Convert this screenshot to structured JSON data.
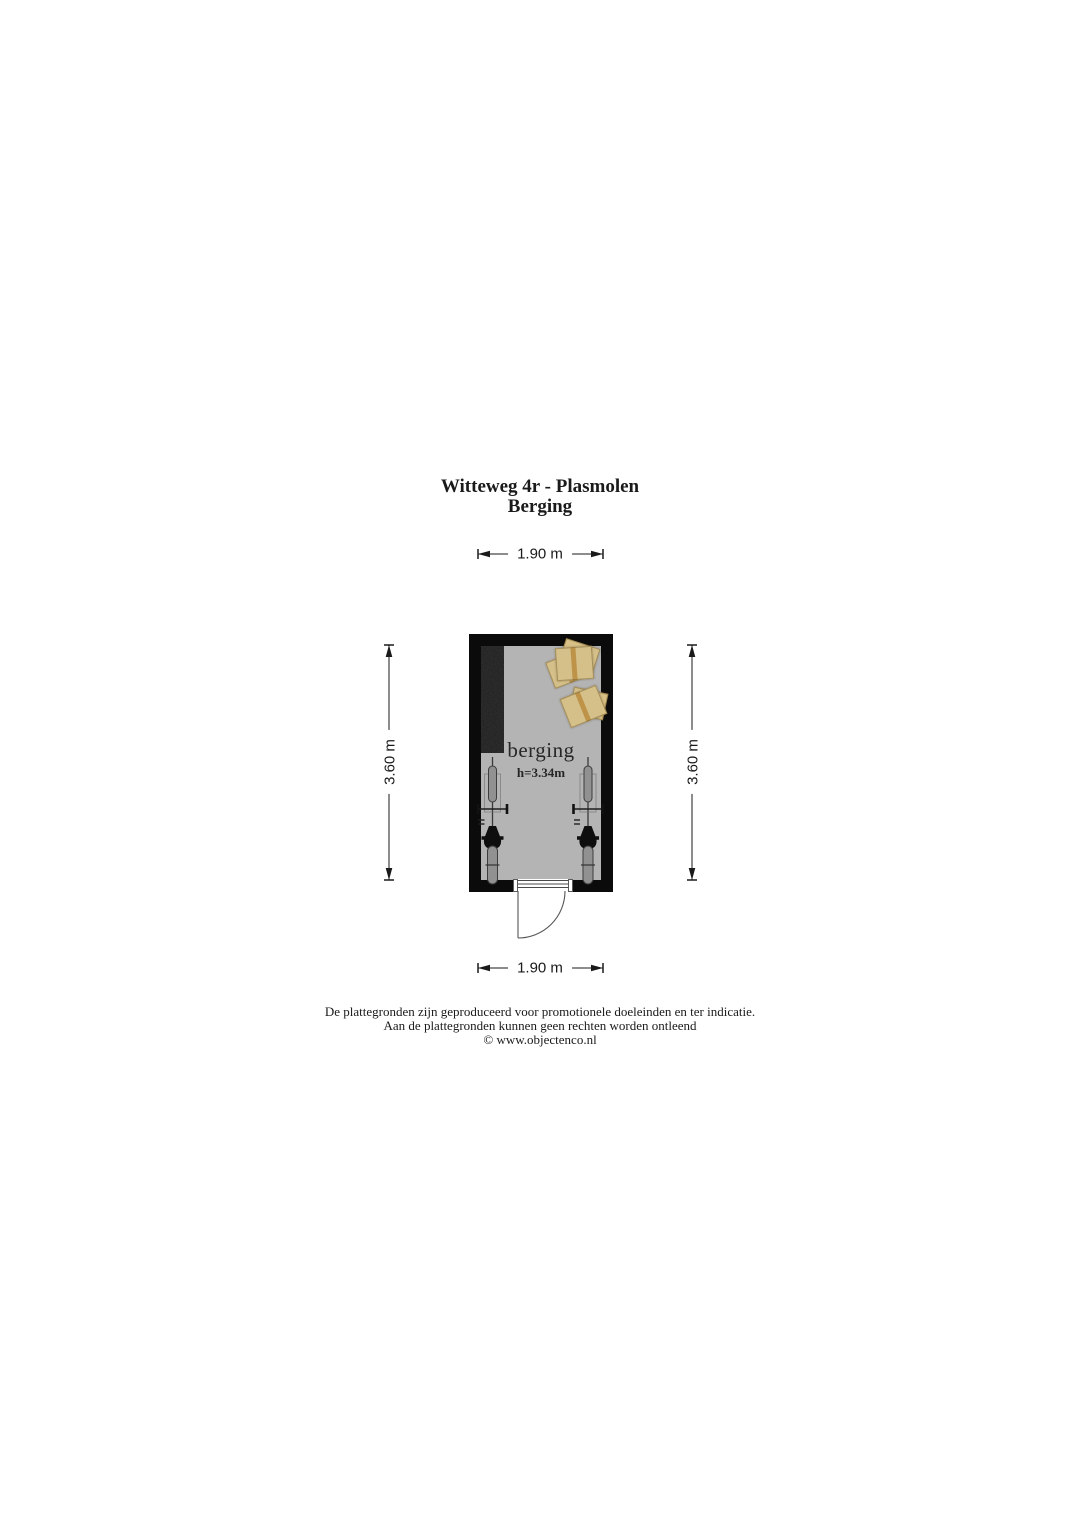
{
  "title": {
    "line1": "Witteweg 4r - Plasmolen",
    "line2": "Berging"
  },
  "room": {
    "name": "berging",
    "height_label": "h=3.34m"
  },
  "dimensions": {
    "width_top": "1.90 m",
    "width_bottom": "1.90 m",
    "height_left": "3.60 m",
    "height_right": "3.60 m"
  },
  "footer": {
    "line1": "De plattegronden zijn geproduceerd voor promotionele doeleinden en ter indicatie.",
    "line2": "Aan de plattegronden kunnen geen rechten worden ontleend",
    "line3": "© www.objectenco.nl"
  },
  "colors": {
    "wall": "#0b0b0b",
    "floor": "#b4b4b4",
    "cabinet": "#1d1d1d",
    "box": "#d8c186",
    "box_tape": "#bf9140",
    "text": "#1a1a1a"
  }
}
